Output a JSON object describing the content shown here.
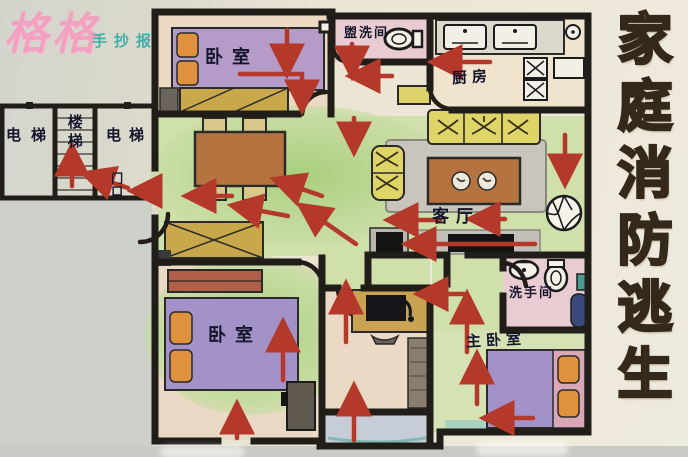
{
  "watermark": {
    "brand": "格格",
    "subtitle": "手抄报"
  },
  "poster_title": {
    "text": "家庭消防逃生",
    "orientation": "vertical"
  },
  "rooms": {
    "bedroom_top": "卧室",
    "washroom": "盥洗间",
    "kitchen": "厨房",
    "living_room": "客厅",
    "bedroom_bottom": "卧室",
    "master_bedroom": "主卧室",
    "bathroom": "洗手间"
  },
  "public_area": {
    "elevator_left": "电梯",
    "stairs": "楼梯",
    "elevator_right": "电梯",
    "entrance": "门口"
  },
  "colors": {
    "escape_arrow": "#b5392a",
    "title_gold": "#e7a238",
    "wall_ink": "#211e1a",
    "floor_green": "#c9dda6",
    "bed_purple": "#a795c6",
    "pillow_orange": "#e0913d",
    "sofa_yellow": "#ded468",
    "bathroom_pink": "#e9ccd2",
    "watermark_pink": "#f2a2c0",
    "watermark_teal": "#3db1a8"
  }
}
